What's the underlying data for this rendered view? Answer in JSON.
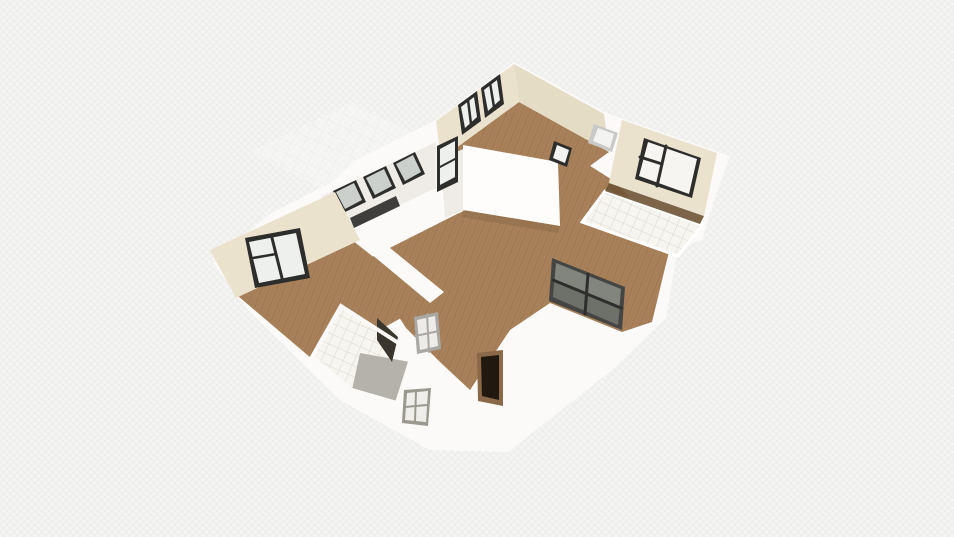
{
  "meta": {
    "app_context": "3d-floorplan-render-viewport",
    "canvas": {
      "width": 954,
      "height": 537
    }
  },
  "palette": {
    "bg": "#f4f4f2",
    "hatch": "#e8e8e6",
    "wallWhite": "#fbfaf8",
    "wallBright": "#fefdfb",
    "wallShade": "#efece7",
    "cream": "#eae2cd",
    "creamDark": "#e5dcc5",
    "wood": "#a8815a",
    "woodLine": "#93714c",
    "woodDark": "#8a6a48",
    "woodShadow": "#6e5335",
    "frame": "#2d2d2b",
    "glassLight": "#eef0ee",
    "glassMid": "#ccd0cc",
    "glassGray": "#81857e",
    "glassGrayDark": "#686c65",
    "tile": "#f6f5f0",
    "tileLine": "#dbd7cd",
    "grayFloor": "#b5b2ab",
    "doorDark": "#211910",
    "doorFrame": "#8a6848",
    "metal": "#9b988f",
    "hallFrameGray": "#c9c9c7",
    "hallFrameInner": "#f3f3f2",
    "darkGlassPanel": "#3a362e",
    "slideFrame": "#454543",
    "slideMullion": "#2e2e2c",
    "white": "#ffffff"
  },
  "scene": {
    "shapes": [
      {
        "n": "background",
        "t": "rect",
        "x": 0,
        "y": 0,
        "w": 954,
        "h": 537,
        "f": "$bg",
        "i": "false"
      },
      {
        "n": "background-weave",
        "t": "rect",
        "x": 0,
        "y": 0,
        "w": 954,
        "h": 537,
        "f": "url(#pat-hatch)",
        "i": "false"
      },
      {
        "n": "terrace-tile-floor",
        "t": "poly",
        "p": "250,152 352,102 430,142 330,192",
        "f": "url(#pat-tile-faint)",
        "o": 0.6,
        "i": "false"
      },
      {
        "n": "house-exterior-walls",
        "t": "poly",
        "p": "514,62 606,113 626,120 730,156 714,200 702,240 678,248 666,318 610,372 508,452 430,450 340,400 250,312 213,263 268,215 332,182 356,160 436,120",
        "f": "$wallWhite",
        "i": "false"
      },
      {
        "n": "living-room-floor",
        "t": "poly",
        "p": "366,260 455,215 468,209 562,163 576,157 614,181 671,243 652,322 622,332 550,303 510,330 470,390 440,362 406,328 388,300",
        "f": "url(#pat-wood)",
        "i": "false"
      },
      {
        "n": "bedroom-floor",
        "t": "poly",
        "p": "238,296 352,240 430,302 318,364",
        "f": "url(#pat-wood)",
        "i": "false"
      },
      {
        "n": "bedroom-living-wall",
        "t": "poly",
        "p": "352,238 368,230 444,292 430,303",
        "f": "$wallWhite",
        "i": "false"
      },
      {
        "n": "top-room-floor",
        "t": "poly",
        "p": "441,159 519,102 609,152 531,209",
        "f": "url(#pat-wood)",
        "i": "false"
      },
      {
        "n": "top-room-wall-left",
        "t": "poly",
        "p": "436,121 514,64 519,102 441,159",
        "f": "$cream",
        "i": "false"
      },
      {
        "n": "top-room-wall-right",
        "t": "poly",
        "p": "514,64 604,114 609,152 519,102",
        "f": "$creamDark",
        "i": "false"
      },
      {
        "n": "top-window-1-frame",
        "t": "poly",
        "p": "458,105 477,91 481,121 462,135",
        "f": "$frame",
        "i": "false"
      },
      {
        "n": "top-window-1-glass",
        "t": "poly",
        "p": "461,107 474,97 477,117 465,128",
        "f": "$glassLight",
        "i": "false"
      },
      {
        "n": "top-window-1-mullion",
        "t": "line",
        "x1": 468,
        "y1": 100,
        "x2": 471,
        "y2": 124,
        "s": "$frame",
        "sw": 2.5,
        "i": "false"
      },
      {
        "n": "top-window-2-frame",
        "t": "poly",
        "p": "481,88 500,74 504,104 485,118",
        "f": "$frame",
        "i": "false"
      },
      {
        "n": "top-window-2-glass",
        "t": "poly",
        "p": "484,90 497,80 500,100 488,111",
        "f": "$glassLight",
        "i": "false"
      },
      {
        "n": "top-window-2-mullion",
        "t": "line",
        "x1": 490,
        "y1": 83,
        "x2": 494,
        "y2": 107,
        "s": "$frame",
        "sw": 2.5,
        "i": "false"
      },
      {
        "n": "top-room-front-wall",
        "t": "poly",
        "p": "463,145 558,162 560,226 463,210",
        "f": "$wallBright",
        "i": "false"
      },
      {
        "n": "front-wall-left-edge",
        "t": "poly",
        "p": "441,159 463,149 463,210 445,218",
        "f": "$wallShade",
        "i": "false"
      },
      {
        "n": "front-wall-floor-shadow",
        "t": "poly",
        "p": "463,210 560,226 558,233 461,217",
        "f": "$woodDark",
        "o": 0.5,
        "i": "false"
      },
      {
        "n": "hallway-doorframe-gray",
        "t": "poly",
        "p": "594,124 618,133 612,152 588,143",
        "f": "$hallFrameGray",
        "i": "false"
      },
      {
        "n": "hallway-doorframe-gray-inner",
        "t": "poly",
        "p": "598,128 614,134 610,148 593,141",
        "f": "$hallFrameInner",
        "i": "false"
      },
      {
        "n": "hallway-doorframe-dark",
        "t": "poly",
        "p": "554,141 572,148 567,167 549,160",
        "f": "$frame",
        "i": "false"
      },
      {
        "n": "hallway-doorframe-dark-inner",
        "t": "poly",
        "p": "557,145 569,150 565,163 553,158",
        "f": "$hallFrameInner",
        "i": "false"
      },
      {
        "n": "bathroom2-tile-floor",
        "t": "poly",
        "p": "605,191 702,225 678,256 582,222",
        "f": "url(#pat-tile)",
        "s": "$white",
        "sw": 3,
        "i": "false"
      },
      {
        "n": "bathroom2-floor-shadow",
        "t": "poly",
        "p": "609,183 704,216 700,224 605,191",
        "f": "$woodShadow",
        "o": 0.9,
        "i": "false"
      },
      {
        "n": "top-right-room-wall",
        "t": "poly",
        "p": "622,120 717,153 704,216 609,183",
        "f": "$cream",
        "i": "false"
      },
      {
        "n": "top-right-window-frame",
        "t": "poly",
        "p": "644,138 701,158 692,198 635,179",
        "f": "$frame",
        "i": "false"
      },
      {
        "n": "top-right-window-glass",
        "t": "poly",
        "p": "648,142 697,159 689,194 639,176",
        "f": "#f6f5f2",
        "i": "false"
      },
      {
        "n": "top-right-window-mullion-v",
        "t": "line",
        "x1": 666,
        "y1": 146,
        "x2": 657,
        "y2": 186,
        "s": "$frame",
        "sw": 3,
        "i": "false"
      },
      {
        "n": "top-right-window-mullion-h",
        "t": "line",
        "x1": 640,
        "y1": 157,
        "x2": 662,
        "y2": 164,
        "s": "$frame",
        "sw": 3,
        "i": "false"
      },
      {
        "n": "kitchen-wall-band",
        "t": "poly",
        "p": "322,196 436,142 436,188 322,242",
        "f": "$wallShade",
        "i": "false"
      },
      {
        "n": "kitchen-window-1-frame",
        "t": "poly",
        "p": "333,191 356,180 366,202 343,213",
        "f": "$frame",
        "i": "false"
      },
      {
        "n": "kitchen-window-1-glass",
        "t": "poly",
        "p": "336,192 354,183 362,200 345,209",
        "f": "$glassMid",
        "i": "false"
      },
      {
        "n": "kitchen-window-2-frame",
        "t": "poly",
        "p": "363,177 386,166 396,188 373,199",
        "f": "$frame",
        "i": "false"
      },
      {
        "n": "kitchen-window-2-glass",
        "t": "poly",
        "p": "366,178 384,169 392,186 375,195",
        "f": "$glassMid",
        "i": "false"
      },
      {
        "n": "kitchen-window-3-frame",
        "t": "poly",
        "p": "393,163 415,152 425,174 403,185",
        "f": "$frame",
        "i": "false"
      },
      {
        "n": "kitchen-window-3-glass",
        "t": "poly",
        "p": "396,164 413,155 421,172 405,181",
        "f": "$glassMid",
        "i": "false"
      },
      {
        "n": "kitchen-lower-opening",
        "t": "poly",
        "p": "350,218 396,196 400,206 354,228",
        "f": "#20201e",
        "o": 0.85,
        "i": "false"
      },
      {
        "n": "tall-window-frame",
        "t": "poly",
        "p": "437,146 458,136 458,182 437,192",
        "f": "$frame",
        "i": "false"
      },
      {
        "n": "tall-window-glass",
        "t": "poly",
        "p": "440,149 455,141 455,177 440,185",
        "f": "$glassLight",
        "i": "false"
      },
      {
        "n": "tall-window-mullion",
        "t": "line",
        "x1": 440,
        "y1": 167,
        "x2": 455,
        "y2": 159,
        "s": "$frame",
        "sw": 2,
        "i": "false"
      },
      {
        "n": "bedroom-wall",
        "t": "poly",
        "p": "210,250 335,192 360,240 236,298",
        "f": "$cream",
        "i": "false"
      },
      {
        "n": "bedroom-window-frame",
        "t": "poly",
        "p": "245,238 300,228 310,278 255,288",
        "f": "$frame",
        "i": "false"
      },
      {
        "n": "bedroom-window-glass",
        "t": "poly",
        "p": "249,242 296,233 305,274 259,283",
        "f": "$glassLight",
        "i": "false"
      },
      {
        "n": "bedroom-window-mullion-v",
        "t": "line",
        "x1": 272,
        "y1": 238,
        "x2": 282,
        "y2": 278,
        "s": "$frame",
        "sw": 3,
        "i": "false"
      },
      {
        "n": "bedroom-window-mullion-h",
        "t": "line",
        "x1": 253,
        "y1": 258,
        "x2": 276,
        "y2": 254,
        "s": "$frame",
        "sw": 2.5,
        "i": "false"
      },
      {
        "n": "bathroom1-tile-floor",
        "t": "poly",
        "p": "341,306 400,344 366,398 312,357",
        "f": "url(#pat-tile)",
        "i": "false"
      },
      {
        "n": "bathroom1-shower-floor",
        "t": "poly",
        "p": "360,353 410,362 397,403 352,390",
        "f": "$grayFloor",
        "i": "false"
      },
      {
        "n": "bathroom1-glass-panel",
        "t": "poly",
        "p": "377,318 398,337 392,362 377,340",
        "f": "$darkGlassPanel",
        "i": "false"
      },
      {
        "n": "bathroom1-wall-outline",
        "t": "poly",
        "p": "341,306 400,344 410,362 397,403 352,390 312,357",
        "f": "none",
        "s": "$wallWhite",
        "sw": 4,
        "i": "false"
      },
      {
        "n": "corridor-door-frame",
        "t": "poly",
        "p": "477,353 503,350 503,406 478,401",
        "f": "$doorFrame",
        "i": "false"
      },
      {
        "n": "corridor-door-panel",
        "t": "poly",
        "p": "481,357 499,355 499,400 482,396",
        "f": "$doorDark",
        "i": "false"
      },
      {
        "n": "south-window-frame",
        "t": "poly",
        "p": "404,390 431,388 428,426 402,423",
        "f": "$metal",
        "i": "false"
      },
      {
        "n": "south-window-glass",
        "t": "poly",
        "p": "407,393 428,391 426,422 405,420",
        "f": "#efeeea",
        "i": "false"
      },
      {
        "n": "south-window-mullion-h",
        "t": "line",
        "x1": 405,
        "y1": 407,
        "x2": 427,
        "y2": 405,
        "s": "$metal",
        "sw": 2,
        "i": "false"
      },
      {
        "n": "south-window-mullion-v",
        "t": "line",
        "x1": 416,
        "y1": 392,
        "x2": 415,
        "y2": 421,
        "s": "$metal",
        "sw": 2,
        "i": "false"
      },
      {
        "n": "bath-wall-window-frame",
        "t": "poly",
        "p": "414,317 438,312 441,349 417,354",
        "f": "#a9a8a3",
        "i": "false"
      },
      {
        "n": "bath-wall-window-glass",
        "t": "poly",
        "p": "417,320 435,316 438,346 420,350",
        "f": "#edece9",
        "i": "false"
      },
      {
        "n": "bath-wall-window-mullion-v",
        "t": "line",
        "x1": 427,
        "y1": 314,
        "x2": 429,
        "y2": 352,
        "s": "#a9a8a3",
        "sw": 2,
        "i": "false"
      },
      {
        "n": "bath-wall-window-mullion-h",
        "t": "line",
        "x1": 415,
        "y1": 336,
        "x2": 439,
        "y2": 331,
        "s": "#a9a8a3",
        "sw": 2,
        "i": "false"
      },
      {
        "n": "sliding-door-frame",
        "t": "poly",
        "p": "552,258 625,287 622,330 549,301",
        "f": "$slideFrame",
        "i": "false"
      },
      {
        "n": "sliding-door-glass",
        "t": "poly",
        "p": "556,263 621,289 618,325 553,297",
        "f": "$glassGray",
        "i": "false"
      },
      {
        "n": "sliding-door-glass-lower",
        "t": "poly",
        "p": "554,281 620,307 618,325 553,297",
        "f": "$glassGrayDark",
        "o": 0.8,
        "i": "false"
      },
      {
        "n": "sliding-door-mullion-v",
        "t": "line",
        "x1": 588,
        "y1": 274,
        "x2": 585,
        "y2": 314,
        "s": "$slideMullion",
        "sw": 3,
        "i": "false"
      },
      {
        "n": "sliding-door-mullion-h",
        "t": "line",
        "x1": 553,
        "y1": 280,
        "x2": 621,
        "y2": 308,
        "s": "$slideMullion",
        "sw": 3,
        "i": "false"
      }
    ]
  }
}
